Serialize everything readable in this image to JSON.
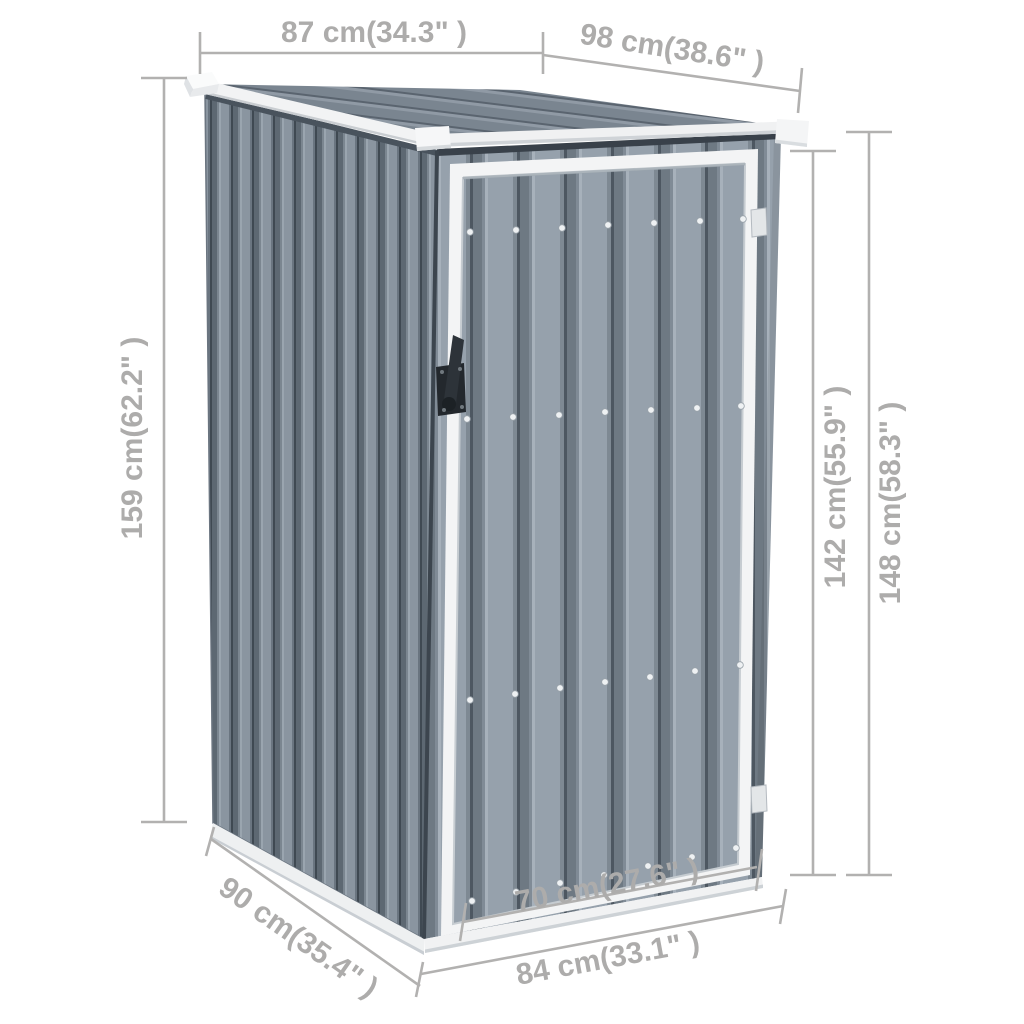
{
  "product": {
    "name": "Garden shed with pent roof, corrugated gray metal, single door",
    "view": "front-left perspective product dimension diagram"
  },
  "dimensions": {
    "roof_depth_top": {
      "label": "87 cm(34.3\" )",
      "meaning": "roof depth (side, top left)"
    },
    "roof_width_top": {
      "label": "98 cm(38.6\" )",
      "meaning": "roof width (front, top right)"
    },
    "height_left": {
      "label": "159 cm(62.2\" )",
      "meaning": "overall height at tall side"
    },
    "height_door": {
      "label": "142 cm(55.9\" )",
      "meaning": "door opening height"
    },
    "height_right": {
      "label": "148 cm(58.3\" )",
      "meaning": "wall height at right side"
    },
    "base_depth": {
      "label": "90 cm(35.4\" )",
      "meaning": "base depth (bottom left)"
    },
    "door_width": {
      "label": "70 cm(27.6\" )",
      "meaning": "door width (bottom center)"
    },
    "base_width": {
      "label": "84 cm(33.1\" )",
      "meaning": "base width (bottom right)"
    }
  },
  "colors": {
    "background": "#ffffff",
    "dimension_lines": "#b2b1b0",
    "dimension_text": "#adacab",
    "wall_face": "#96a1ac",
    "wall_groove": "#4d5761",
    "left_wall_face": "#8a95a0",
    "roof_face": "#7a8590",
    "trim_white": "#f2f3f4",
    "handle_black": "#23282d"
  }
}
